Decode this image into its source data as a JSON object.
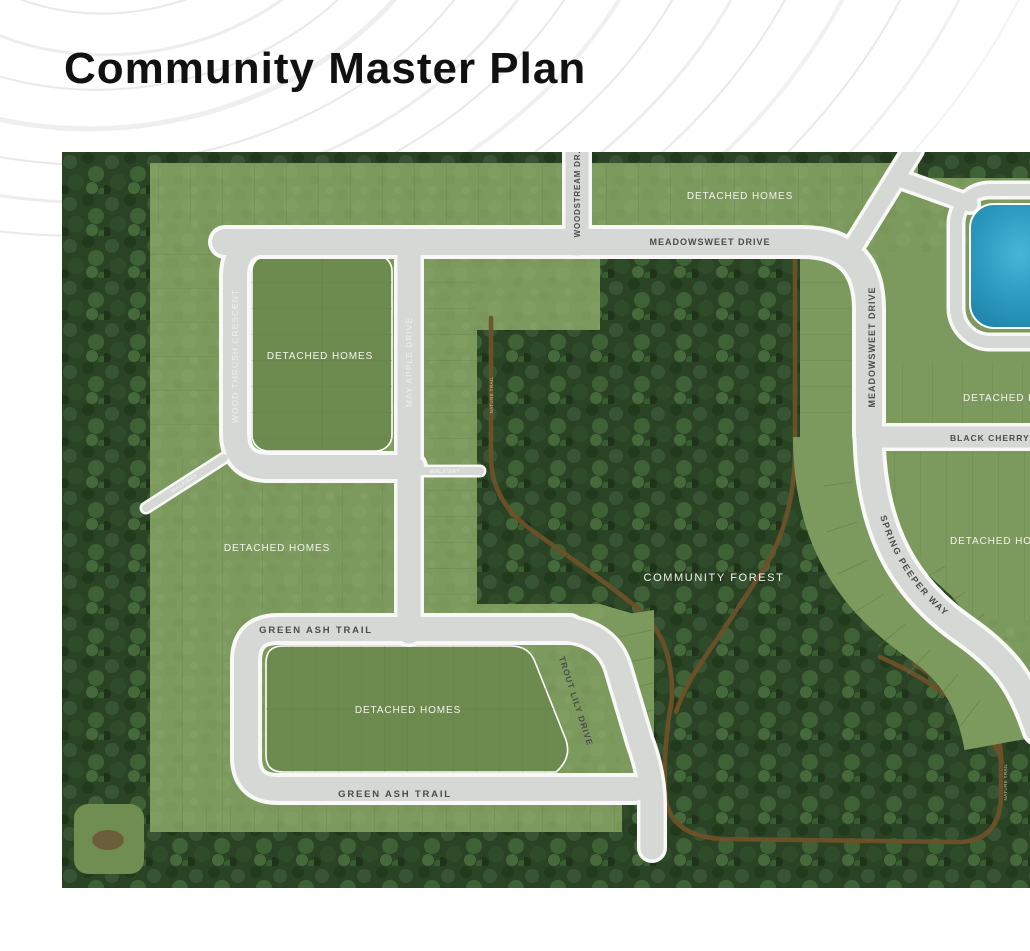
{
  "page": {
    "title": "Community Master Plan"
  },
  "map": {
    "areas": {
      "detached_homes_north": "DETACHED HOMES",
      "detached_homes_west": "DETACHED HOMES",
      "detached_homes_southwest": "DETACHED HOMES",
      "detached_homes_south": "DETACHED HOMES",
      "detached_homes_east": "DETACHED HOMES",
      "detached_homes_southeast": "DETACHED HOMES",
      "community_forest": "COMMUNITY FOREST"
    },
    "streets": {
      "woodstream_dr": "WOODSTREAM DR.",
      "meadowsweet_drive_top": "MEADOWSWEET DRIVE",
      "meadowsweet_drive_east": "MEADOWSWEET DRIVE",
      "wood_thrush_crescent": "WOOD THRUSH CRESCENT",
      "may_apple_drive": "MAY APPLE DRIVE",
      "green_ash_trail_north": "GREEN ASH TRAIL",
      "green_ash_trail_south": "GREEN ASH TRAIL",
      "trout_lily_drive": "TROUT LILY DRIVE",
      "spring_peeper_way": "SPRING PEEPER WAY",
      "black_cherry": "BLACK CHERRY",
      "walkway_west": "WALKWAY",
      "walkway_central": "WALKWAY",
      "nature_trail_west": "NATURE TRAIL",
      "nature_trail_east": "NATURE TRAIL"
    },
    "colors": {
      "lot_green": "#7d9a5e",
      "block_green": "#6e8b4f",
      "forest_green": "#2b4325",
      "road_grey": "#d6d8d5",
      "pond_blue": "#2a97bc",
      "trail_brown": "#6e5128",
      "street_label_dark": "#484d4e",
      "street_label_light": "#f2f3ee"
    }
  }
}
